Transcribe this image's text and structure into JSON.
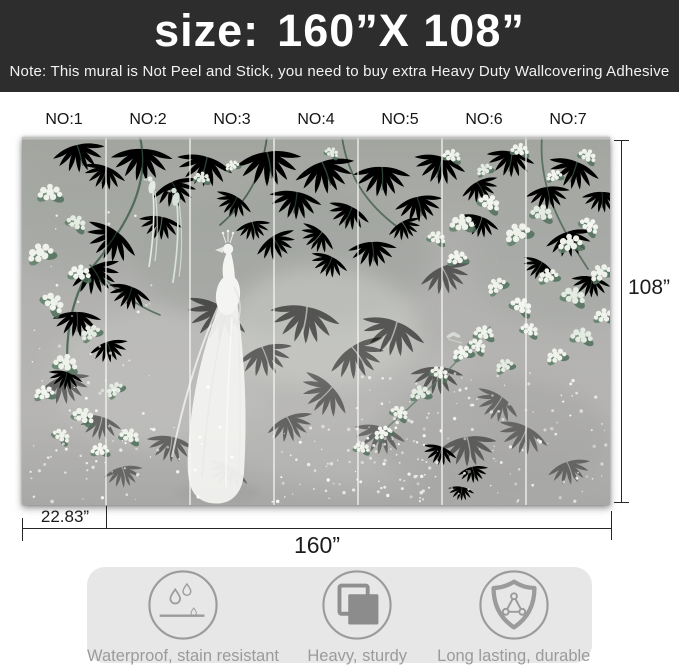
{
  "header": {
    "size_label": "size:",
    "size_value": "160”X 108”",
    "note": "Note: This mural is Not Peel and Stick, you need to buy extra Heavy Duty Wallcovering Adhesive"
  },
  "panel_labels": [
    "NO:1",
    "NO:2",
    "NO:3",
    "NO:4",
    "NO:5",
    "NO:6",
    "NO:7"
  ],
  "dimensions": {
    "height": "108”",
    "width": "160”",
    "panel_width": "22.83”"
  },
  "features": [
    {
      "icon": "water-drops-icon",
      "label": "Waterproof, stain resistant"
    },
    {
      "icon": "stacked-squares-icon",
      "label": "Heavy, sturdy"
    },
    {
      "icon": "shield-network-icon",
      "label": "Long lasting, durable"
    }
  ],
  "colors": {
    "banner_bg": "#2d2d2d",
    "banner_text": "#ffffff",
    "dimension_line": "#262626",
    "features_bg": "#e7e7e7",
    "features_fg": "#9b9b9b",
    "mural_bg": "#aeaeac",
    "foliage_dark": "#3a5645",
    "foliage_light": "#7d987f",
    "flower_white": "#eef2ea"
  }
}
